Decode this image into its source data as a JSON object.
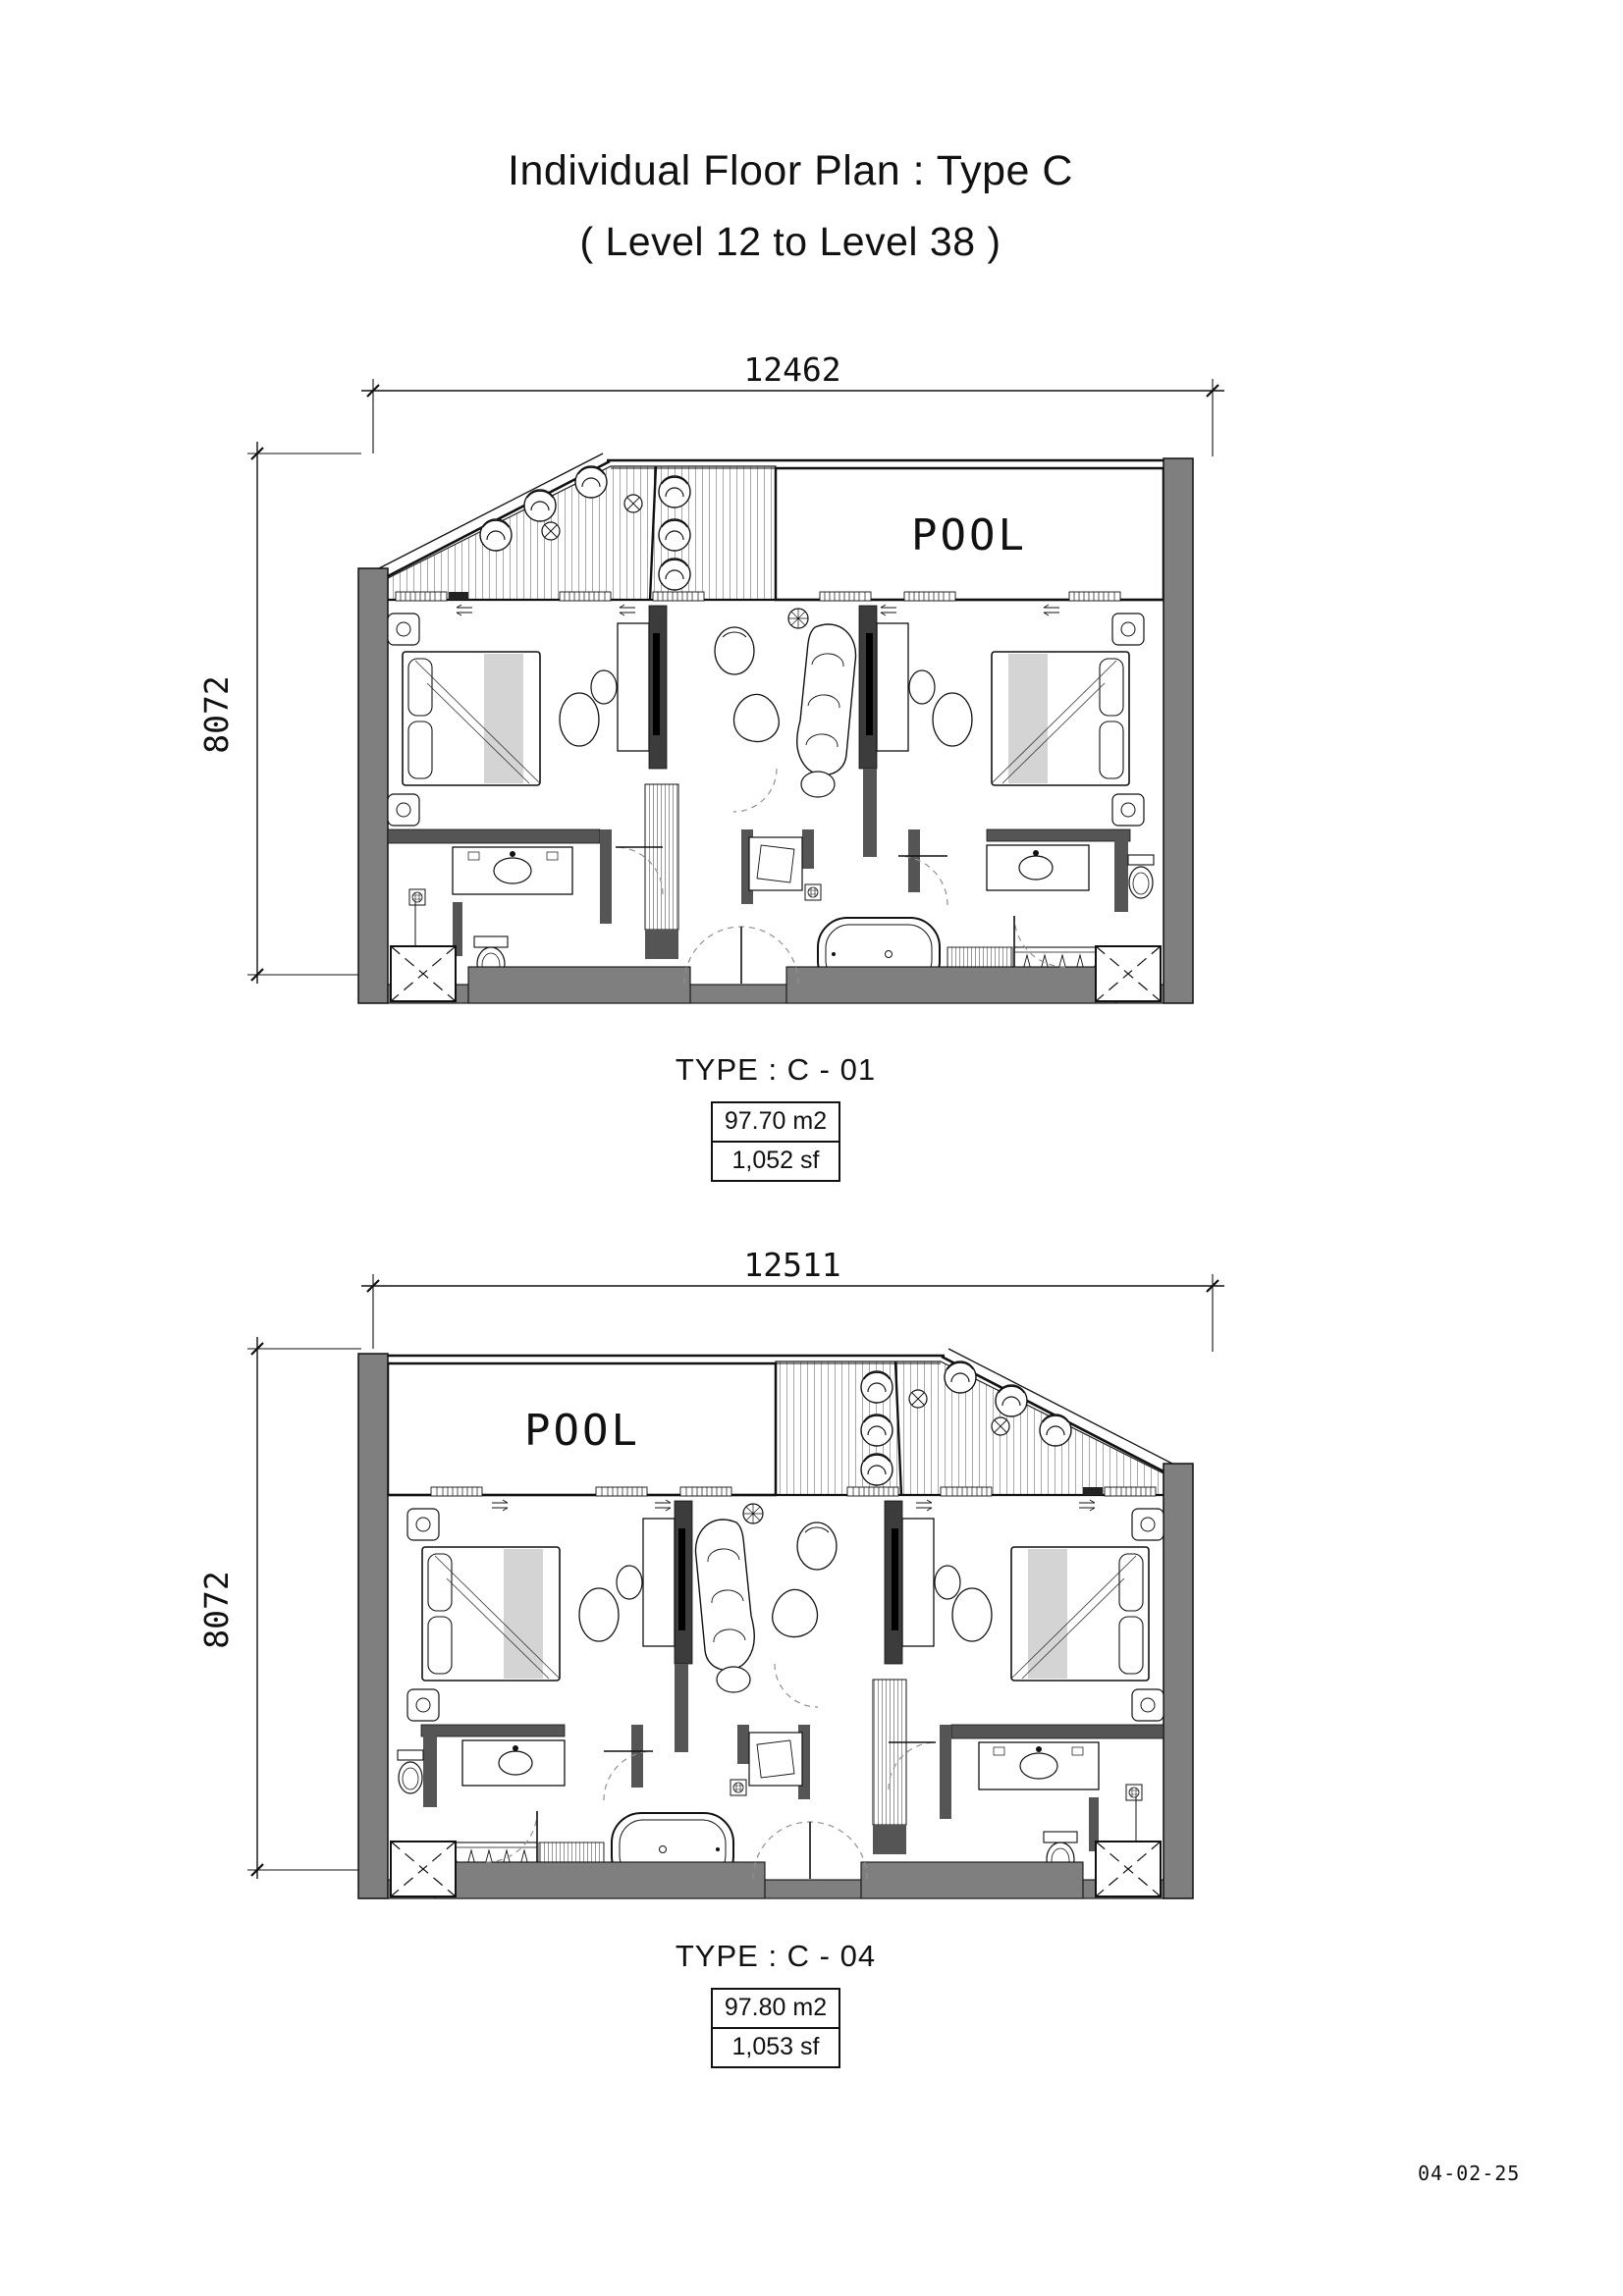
{
  "title": {
    "line1": "Individual Floor Plan : Type C",
    "line2": "( Level 12 to Level 38 )"
  },
  "plans": [
    {
      "name": "floor-plan-c01",
      "type_label": "TYPE : C - 01",
      "area_m2": "97.70 m2",
      "area_sf": "1,052 sf",
      "width_dim": "12462",
      "height_dim": "8072",
      "pool_label": "POOL"
    },
    {
      "name": "floor-plan-c04",
      "type_label": "TYPE : C - 04",
      "area_m2": "97.80 m2",
      "area_sf": "1,053 sf",
      "width_dim": "12511",
      "height_dim": "8072",
      "pool_label": "POOL"
    }
  ],
  "footer": {
    "date": "04-02-25"
  },
  "colors": {
    "wall_gray": "#7f7f7f",
    "dark_wall": "#4a4a4a",
    "line": "#111111",
    "blanket": "#d4d4d4",
    "door_arc": "#909090"
  }
}
